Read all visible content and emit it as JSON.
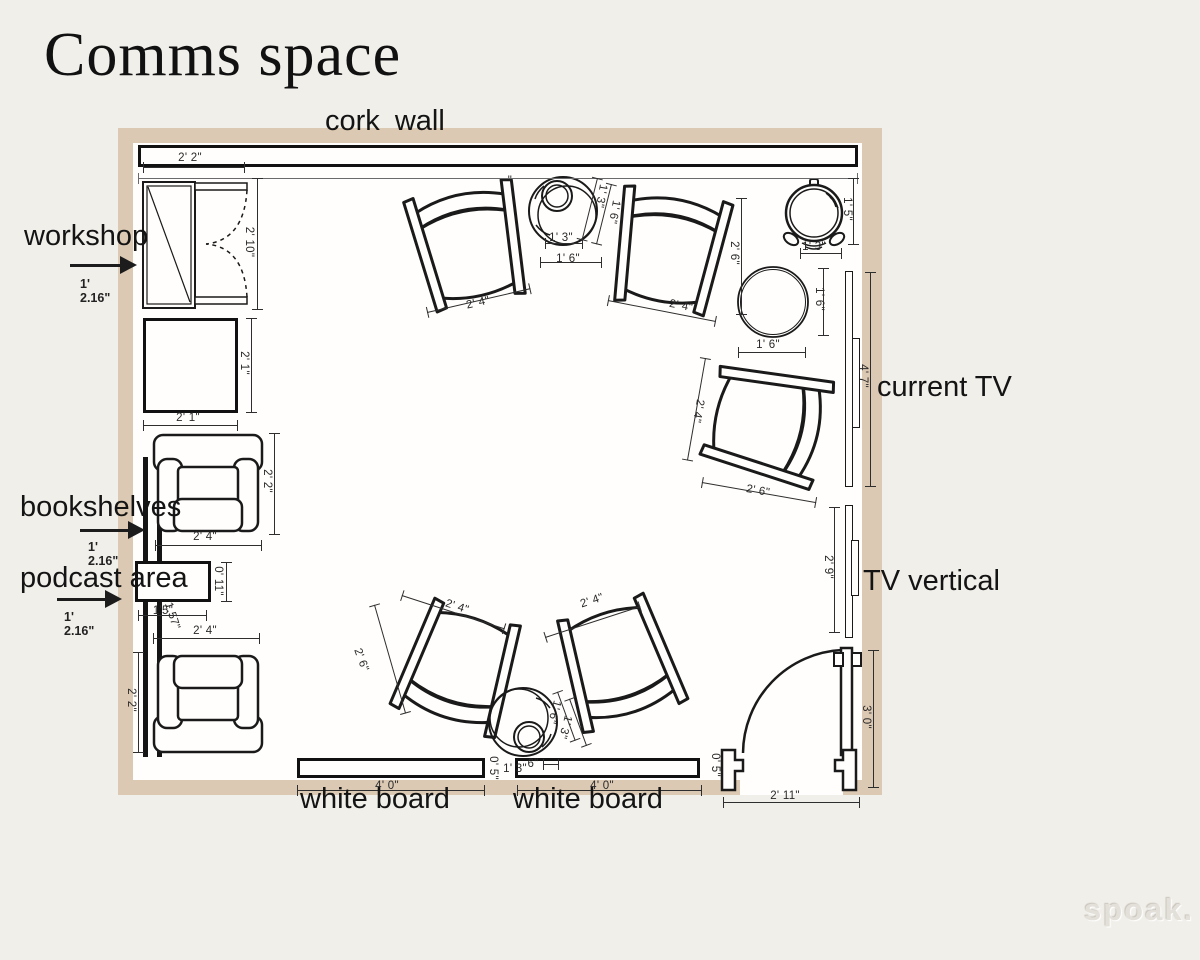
{
  "title": "Comms space",
  "watermark": "spoak.",
  "colors": {
    "background": "#f1efea",
    "wall": "#dcc9b3",
    "interior": "#fffefc",
    "line": "#1a1a1a",
    "dim": "#2e2e2e"
  },
  "annotations": {
    "cork_wall": "cork wall",
    "workshop": {
      "label": "workshop",
      "dim": "1' 2.16\""
    },
    "bookshelves": {
      "label": "bookshelves",
      "dim": "1' 2.16\""
    },
    "podcast_area": {
      "label": "podcast area",
      "dim": "1' 2.16\""
    },
    "current_tv": "current TV",
    "tv_vertical": "TV vertical",
    "whiteboard_left": "white board",
    "whiteboard_right": "white board"
  },
  "dim_labels": [
    {
      "t": "2' 2\"",
      "x": 190,
      "y": 158,
      "r": 0
    },
    {
      "t": "2' 10\"",
      "x": 249,
      "y": 242,
      "r": 90
    },
    {
      "t": "2' 1\"",
      "x": 188,
      "y": 418,
      "r": 0
    },
    {
      "t": "2' 1\"",
      "x": 244,
      "y": 363,
      "r": 90
    },
    {
      "t": "2' 2\"",
      "x": 267,
      "y": 481,
      "r": 90
    },
    {
      "t": "2' 4\"",
      "x": 205,
      "y": 537,
      "r": 0
    },
    {
      "t": "0' 11\"",
      "x": 218,
      "y": 581,
      "r": 90
    },
    {
      "t": "1'5\"",
      "x": 163,
      "y": 611,
      "r": 0
    },
    {
      "t": "1.57\"",
      "x": 172,
      "y": 616,
      "r": 72
    },
    {
      "t": "2' 4\"",
      "x": 205,
      "y": 631,
      "r": 0
    },
    {
      "t": "2' 2\"",
      "x": 131,
      "y": 700,
      "r": 90
    },
    {
      "t": "4' 0\"",
      "x": 387,
      "y": 786,
      "r": 0
    },
    {
      "t": "4' 0\"",
      "x": 602,
      "y": 786,
      "r": 0
    },
    {
      "t": "2' 11\"",
      "x": 785,
      "y": 796,
      "r": 0
    },
    {
      "t": "3' 0\"",
      "x": 866,
      "y": 717,
      "r": 90
    },
    {
      "t": "4' 7\"",
      "x": 863,
      "y": 376,
      "r": 90
    },
    {
      "t": "2' 9\"",
      "x": 828,
      "y": 567,
      "r": 90
    },
    {
      "t": "1' 5\"",
      "x": 847,
      "y": 209,
      "r": 90
    },
    {
      "t": "1' 3\"",
      "x": 814,
      "y": 247,
      "r": 0
    },
    {
      "t": "1' 6\"",
      "x": 819,
      "y": 299,
      "r": 90
    },
    {
      "t": "1' 6\"",
      "x": 768,
      "y": 345,
      "r": 0
    },
    {
      "t": "2' 6\"",
      "x": 734,
      "y": 253,
      "r": 90
    },
    {
      "t": "2' 4\"",
      "x": 478,
      "y": 303,
      "r": -13
    },
    {
      "t": "2' 4\"",
      "x": 681,
      "y": 306,
      "r": 11
    },
    {
      "t": "1' 3\"",
      "x": 601,
      "y": 196,
      "r": 100
    },
    {
      "t": "1' 6\"",
      "x": 614,
      "y": 212,
      "r": 100
    },
    {
      "t": "1' 3\"",
      "x": 561,
      "y": 238,
      "r": 0
    },
    {
      "t": "1' 6\"",
      "x": 568,
      "y": 259,
      "r": 0
    },
    {
      "t": "2' 4\"",
      "x": 698,
      "y": 411,
      "r": 100
    },
    {
      "t": "2' 6\"",
      "x": 758,
      "y": 491,
      "r": 10
    },
    {
      "t": "2' 4\"",
      "x": 457,
      "y": 607,
      "r": 18
    },
    {
      "t": "2' 6\"",
      "x": 361,
      "y": 660,
      "r": 70
    },
    {
      "t": "2' 4\"",
      "x": 592,
      "y": 601,
      "r": -18
    },
    {
      "t": "1' 6\"",
      "x": 554,
      "y": 712,
      "r": 105
    },
    {
      "t": "1' 3\"",
      "x": 565,
      "y": 727,
      "r": 105
    },
    {
      "t": "0' 5\"",
      "x": 493,
      "y": 768,
      "r": 90
    },
    {
      "t": "1' 3\"",
      "x": 515,
      "y": 769,
      "r": 0
    },
    {
      "t": "6\"",
      "x": 533,
      "y": 764,
      "r": 0
    },
    {
      "t": "0' 5\"",
      "x": 715,
      "y": 765,
      "r": 90
    },
    {
      "t": "\"",
      "x": 510,
      "y": 181,
      "r": 0
    }
  ],
  "dim_lines": [
    {
      "x": 143,
      "y": 167,
      "l": 102,
      "v": false
    },
    {
      "x": 138,
      "y": 178,
      "l": 720,
      "v": false,
      "light": true
    },
    {
      "x": 257,
      "y": 178,
      "l": 132,
      "v": true
    },
    {
      "x": 143,
      "y": 425,
      "l": 95,
      "v": false
    },
    {
      "x": 251,
      "y": 318,
      "l": 95,
      "v": true
    },
    {
      "x": 274,
      "y": 433,
      "l": 102,
      "v": true
    },
    {
      "x": 155,
      "y": 545,
      "l": 107,
      "v": false
    },
    {
      "x": 226,
      "y": 562,
      "l": 40,
      "v": true
    },
    {
      "x": 138,
      "y": 615,
      "l": 69,
      "v": false
    },
    {
      "x": 153,
      "y": 638,
      "l": 107,
      "v": false
    },
    {
      "x": 138,
      "y": 652,
      "l": 101,
      "v": true
    },
    {
      "x": 297,
      "y": 790,
      "l": 188,
      "v": false
    },
    {
      "x": 517,
      "y": 790,
      "l": 185,
      "v": false
    },
    {
      "x": 723,
      "y": 802,
      "l": 137,
      "v": false
    },
    {
      "x": 873,
      "y": 650,
      "l": 138,
      "v": true
    },
    {
      "x": 870,
      "y": 272,
      "l": 215,
      "v": true
    },
    {
      "x": 834,
      "y": 507,
      "l": 126,
      "v": true
    },
    {
      "x": 853,
      "y": 178,
      "l": 67,
      "v": true
    },
    {
      "x": 800,
      "y": 253,
      "l": 42,
      "v": false
    },
    {
      "x": 823,
      "y": 268,
      "l": 68,
      "v": true
    },
    {
      "x": 738,
      "y": 352,
      "l": 68,
      "v": false
    },
    {
      "x": 741,
      "y": 198,
      "l": 117,
      "v": true
    },
    {
      "x": 427,
      "y": 312,
      "l": 106,
      "v": false,
      "r": -13
    },
    {
      "x": 608,
      "y": 300,
      "l": 110,
      "v": false,
      "r": 11
    },
    {
      "x": 540,
      "y": 262,
      "l": 62,
      "v": false
    },
    {
      "x": 545,
      "y": 243,
      "l": 38,
      "v": false
    },
    {
      "x": 705,
      "y": 358,
      "l": 104,
      "v": true,
      "r": 10
    },
    {
      "x": 702,
      "y": 482,
      "l": 116,
      "v": false,
      "r": 10
    },
    {
      "x": 402,
      "y": 595,
      "l": 108,
      "v": false,
      "r": 18
    },
    {
      "x": 374,
      "y": 605,
      "l": 113,
      "v": true,
      "r": -16
    },
    {
      "x": 545,
      "y": 637,
      "l": 100,
      "v": false,
      "r": -18
    },
    {
      "x": 557,
      "y": 692,
      "l": 52,
      "v": true,
      "r": -20
    },
    {
      "x": 569,
      "y": 699,
      "l": 50,
      "v": true,
      "r": -20
    },
    {
      "x": 597,
      "y": 178,
      "l": 64,
      "v": true,
      "r": 14
    },
    {
      "x": 611,
      "y": 184,
      "l": 62,
      "v": true,
      "r": 14
    },
    {
      "x": 543,
      "y": 764,
      "l": 16,
      "v": false
    }
  ]
}
